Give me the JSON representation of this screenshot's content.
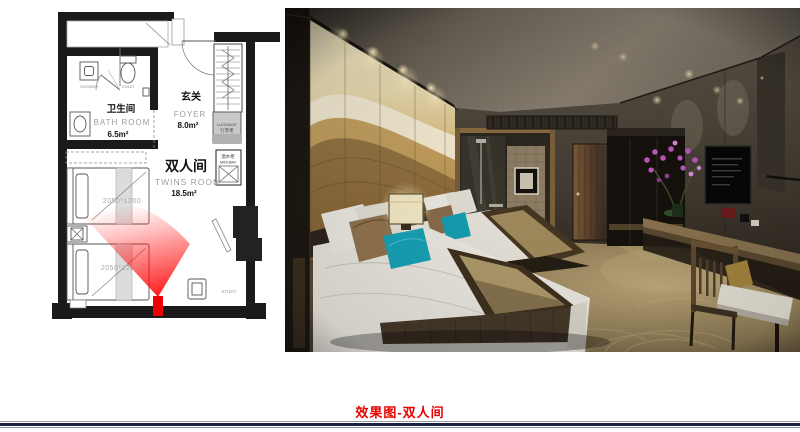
{
  "caption": {
    "text": "效果图-双人间"
  },
  "floor_plan": {
    "bathroom_cn": "卫生间",
    "bathroom_en": "BATH ROOM",
    "bathroom_area": "6.5m²",
    "foyer_cn": "玄关",
    "foyer_en": "FOYER",
    "foyer_area": "8.0m²",
    "twin_cn": "双人间",
    "twin_en": "TWINS ROOM",
    "twin_area": "18.5m²",
    "shower": "SHOWER",
    "toilet": "TOILET",
    "luggage_en": "LUGGAGE",
    "luggage_cn": "行李柜",
    "minibar_cn": "酒水柜",
    "minibar_en": "MINI BAR",
    "study": "STUDY",
    "bed1_size": "2050*1200",
    "bed2_size": "2050*1200"
  },
  "colors": {
    "camera_cone": "#ee0000",
    "caption_text": "#e80000",
    "bottom_rule": "#1b2140",
    "accent_teal": "#18a0b4"
  }
}
